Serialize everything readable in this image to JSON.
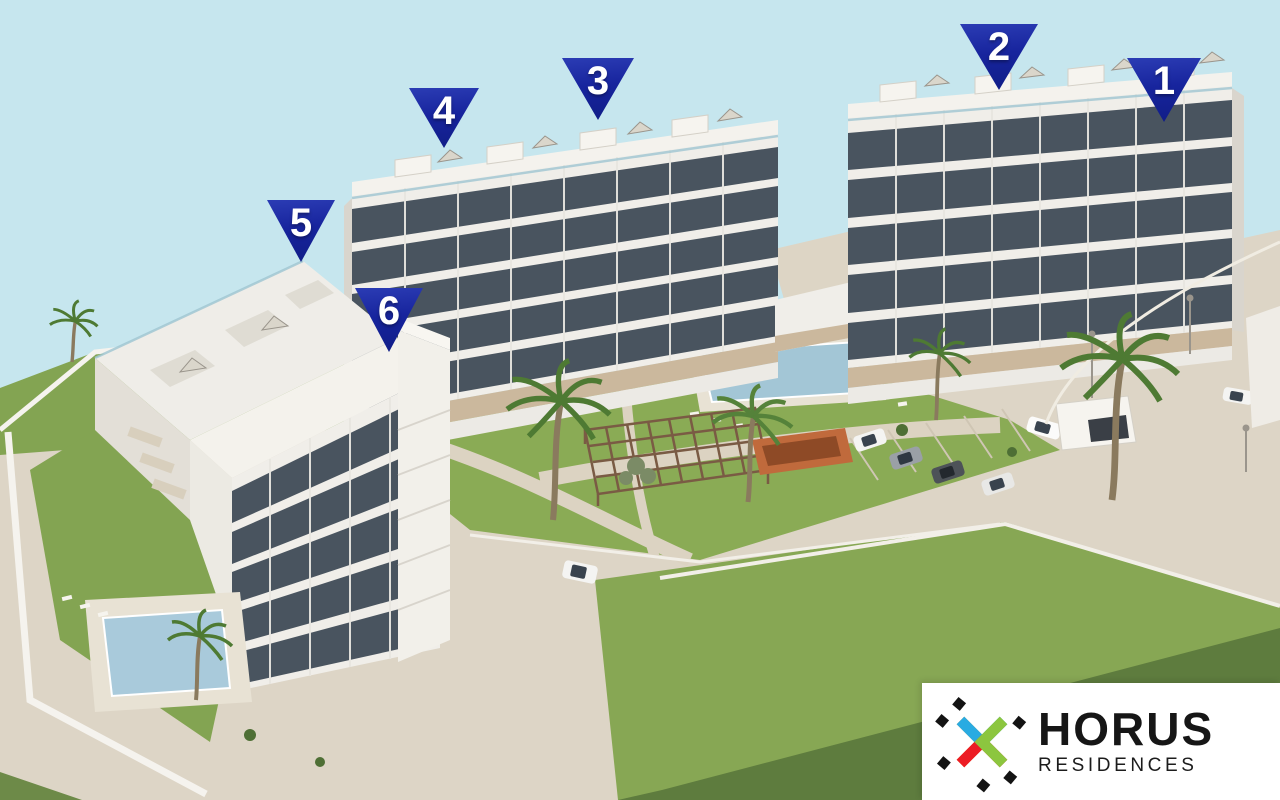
{
  "scene": {
    "kind": "aerial-3d-architectural-render",
    "description": "Aerial 3D rendering of the Horus Residences complex: three white apartment blocks with glazed balcony bands and rooftop terraces around a landscaped courtyard with swimming pools, palm trees, a pergola, parking areas and perimeter roads. Six numbered blue triangular markers identify the buildings.",
    "colors": {
      "sky": "#c6e6ee",
      "grass": "#87a754",
      "grass_dark": "#5e7c3e",
      "ground": "#ddd5c6",
      "building": "#f0eee9",
      "window_band": "#49545f",
      "pool": "#a3c6d6",
      "marker": "#17249d",
      "pergola": "#7a5b44",
      "accent_seating": "#c06a3c",
      "wall": "#f5f3ee"
    }
  },
  "markers": [
    {
      "label": "1"
    },
    {
      "label": "2"
    },
    {
      "label": "3"
    },
    {
      "label": "4"
    },
    {
      "label": "5"
    },
    {
      "label": "6"
    }
  ],
  "logo": {
    "title": "HORUS",
    "subtitle": "RESIDENCES",
    "mark_colors": {
      "orange": "#F7941E",
      "blue": "#29ABE2",
      "red": "#EC1C24",
      "green": "#8CC63F",
      "black": "#131313"
    }
  }
}
